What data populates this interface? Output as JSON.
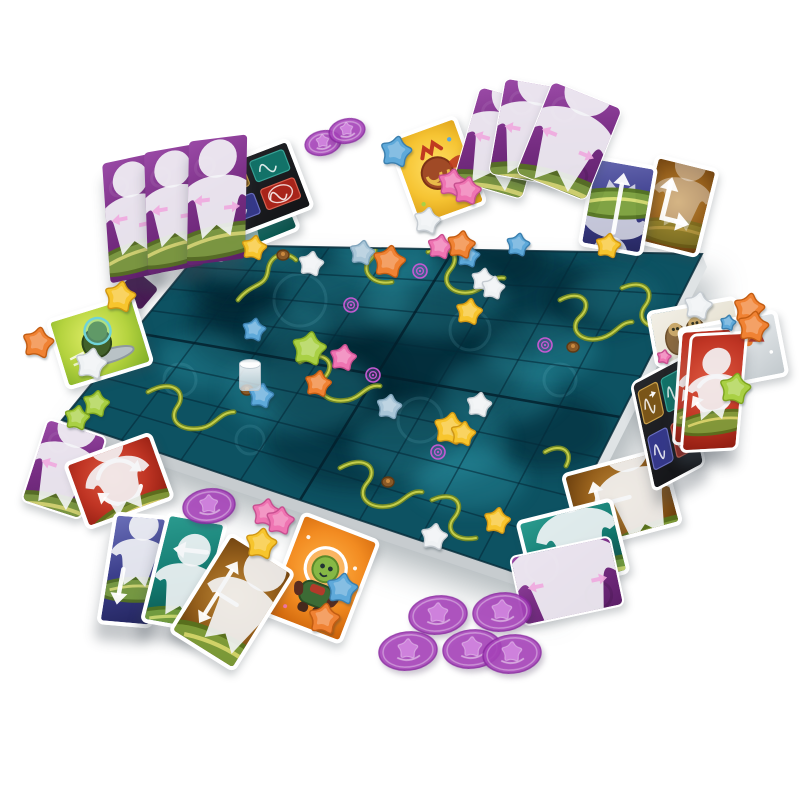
{
  "scene": {
    "title": "board-game-table-photo",
    "background": "#ffffff"
  },
  "board": {
    "corners": [
      [
        205,
        245
      ],
      [
        702,
        254
      ],
      [
        538,
        580
      ],
      [
        62,
        420
      ]
    ],
    "grid_divisions": 8,
    "base_color": "#0d5262",
    "edge_color": "#dfe3e5",
    "side_color": "#c7cccf",
    "line_color": "rgba(5,42,56,0.60)",
    "fold_color": "rgba(3,30,42,0.80)",
    "cloud_dark": "#02222e",
    "cloud_light": "#2f98a9",
    "clouds_dark": [
      [
        300,
        310,
        95,
        60
      ],
      [
        420,
        355,
        115,
        70
      ],
      [
        515,
        300,
        85,
        52
      ],
      [
        255,
        330,
        70,
        45
      ],
      [
        360,
        435,
        95,
        55
      ],
      [
        545,
        430,
        65,
        40
      ],
      [
        490,
        262,
        55,
        30
      ],
      [
        235,
        285,
        48,
        30
      ],
      [
        330,
        380,
        70,
        45
      ],
      [
        600,
        300,
        55,
        32
      ],
      [
        390,
        370,
        130,
        80
      ]
    ],
    "clouds_light": [
      [
        255,
        258,
        55,
        26
      ],
      [
        345,
        298,
        65,
        36
      ],
      [
        435,
        300,
        72,
        38
      ],
      [
        300,
        392,
        75,
        42
      ],
      [
        430,
        442,
        78,
        42
      ],
      [
        540,
        350,
        58,
        32
      ],
      [
        615,
        297,
        46,
        26
      ],
      [
        205,
        360,
        48,
        28
      ],
      [
        470,
        480,
        55,
        30
      ],
      [
        385,
        252,
        52,
        26
      ],
      [
        290,
        330,
        40,
        22
      ],
      [
        500,
        390,
        60,
        34
      ]
    ],
    "swirls": [
      [
        300,
        300,
        26
      ],
      [
        470,
        330,
        20
      ],
      [
        180,
        380,
        16
      ],
      [
        420,
        420,
        22
      ],
      [
        560,
        380,
        16
      ],
      [
        250,
        440,
        14
      ]
    ],
    "vines": [
      "M238,300 C252,282 266,288 268,270 C270,254 286,250 296,260",
      "M352,242 C372,232 382,248 370,260 C360,270 372,286 392,282",
      "M428,252 C450,242 462,256 450,270 C440,282 452,296 472,292 C486,288 492,276 504,278",
      "M560,300 C582,288 594,304 580,317 C568,328 580,344 602,338 C616,334 620,322 632,322",
      "M622,288 C644,278 656,292 645,306 C636,318 646,330 666,326",
      "M148,392 C172,378 188,392 177,407 C168,420 180,432 202,428 C216,425 220,412 234,412",
      "M300,362 C322,348 338,362 325,377 C314,390 326,404 348,400 C362,397 366,384 380,386",
      "M340,468 C364,454 380,468 367,483 C356,496 368,510 390,506 C404,503 408,490 422,492",
      "M432,500 C454,490 466,504 454,518 C444,530 456,542 476,538",
      "M545,452 C562,442 574,452 566,466"
    ],
    "vine_dark": "#6f8726",
    "vine_light": "#c8d24c",
    "pods": [
      [
        283,
        255
      ],
      [
        388,
        482
      ],
      [
        573,
        347
      ],
      [
        247,
        390
      ]
    ],
    "pod_color": "#8a5a28",
    "spirals": [
      [
        420,
        271
      ],
      [
        351,
        305
      ],
      [
        373,
        375
      ],
      [
        545,
        345
      ],
      [
        438,
        452
      ]
    ],
    "spiral_color": "#c45ad2",
    "cup": {
      "x": 239,
      "y": 362
    }
  },
  "star_colors": {
    "white": {
      "f": "#eff2f4",
      "s": "#c6ccd2"
    },
    "yellow": {
      "f": "#f7c52d",
      "s": "#cf9513"
    },
    "pink": {
      "f": "#ef74b2",
      "s": "#c74f90"
    },
    "blue": {
      "f": "#5ea9da",
      "s": "#3b7fae"
    },
    "lightblue": {
      "f": "#a9c6d8",
      "s": "#7fa3bb"
    },
    "orange": {
      "f": "#f08233",
      "s": "#c25c12"
    },
    "green": {
      "f": "#a9d044",
      "s": "#7da41f"
    }
  },
  "tokens": [
    {
      "color": "white",
      "x": 427,
      "y": 221,
      "s": 17
    },
    {
      "color": "pink",
      "x": 440,
      "y": 247,
      "s": 16
    },
    {
      "color": "lightblue",
      "x": 362,
      "y": 253,
      "s": 16
    },
    {
      "color": "orange",
      "x": 389,
      "y": 262,
      "s": 21
    },
    {
      "color": "white",
      "x": 311,
      "y": 264,
      "s": 16
    },
    {
      "color": "yellow",
      "x": 254,
      "y": 248,
      "s": 16
    },
    {
      "color": "blue",
      "x": 468,
      "y": 256,
      "s": 15
    },
    {
      "color": "white",
      "x": 483,
      "y": 280,
      "s": 15
    },
    {
      "color": "white",
      "x": 493,
      "y": 288,
      "s": 15
    },
    {
      "color": "yellow",
      "x": 469,
      "y": 312,
      "s": 17
    },
    {
      "color": "green",
      "x": 309,
      "y": 349,
      "s": 22
    },
    {
      "color": "pink",
      "x": 343,
      "y": 358,
      "s": 17
    },
    {
      "color": "orange",
      "x": 318,
      "y": 384,
      "s": 17
    },
    {
      "color": "blue",
      "x": 254,
      "y": 330,
      "s": 15
    },
    {
      "color": "blue",
      "x": 261,
      "y": 396,
      "s": 16
    },
    {
      "color": "lightblue",
      "x": 389,
      "y": 407,
      "s": 16
    },
    {
      "color": "white",
      "x": 479,
      "y": 405,
      "s": 16
    },
    {
      "color": "yellow",
      "x": 450,
      "y": 429,
      "s": 21
    },
    {
      "color": "yellow",
      "x": 463,
      "y": 434,
      "s": 16
    },
    {
      "color": "yellow",
      "x": 497,
      "y": 521,
      "s": 17
    },
    {
      "color": "white",
      "x": 434,
      "y": 537,
      "s": 17
    },
    {
      "color": "green",
      "x": 96,
      "y": 404,
      "s": 17
    },
    {
      "color": "green",
      "x": 77,
      "y": 418,
      "s": 16
    },
    {
      "color": "blue",
      "x": 518,
      "y": 245,
      "s": 15
    },
    {
      "color": "yellow",
      "x": 608,
      "y": 246,
      "s": 16
    },
    {
      "color": "blue",
      "x": 396,
      "y": 152,
      "s": 20
    },
    {
      "color": "pink",
      "x": 452,
      "y": 183,
      "s": 18
    },
    {
      "color": "pink",
      "x": 467,
      "y": 191,
      "s": 18
    },
    {
      "color": "orange",
      "x": 461,
      "y": 245,
      "s": 18
    },
    {
      "color": "white",
      "x": 698,
      "y": 306,
      "s": 18
    },
    {
      "color": "orange",
      "x": 749,
      "y": 309,
      "s": 20
    },
    {
      "color": "orange",
      "x": 753,
      "y": 327,
      "s": 20
    },
    {
      "color": "blue",
      "x": 728,
      "y": 323,
      "s": 10
    },
    {
      "color": "green",
      "x": 735,
      "y": 389,
      "s": 20
    },
    {
      "color": "pink",
      "x": 266,
      "y": 513,
      "s": 18
    },
    {
      "color": "pink",
      "x": 280,
      "y": 521,
      "s": 18
    },
    {
      "color": "yellow",
      "x": 261,
      "y": 544,
      "s": 20
    },
    {
      "color": "blue",
      "x": 342,
      "y": 589,
      "s": 20
    },
    {
      "color": "orange",
      "x": 324,
      "y": 619,
      "s": 20
    },
    {
      "color": "yellow",
      "x": 120,
      "y": 297,
      "s": 20
    },
    {
      "color": "orange",
      "x": 38,
      "y": 343,
      "s": 20
    },
    {
      "color": "white",
      "x": 91,
      "y": 364,
      "s": 20
    },
    {
      "color": "pink",
      "x": 664,
      "y": 357,
      "s": 9
    }
  ],
  "discs": {
    "fill": "#a944bc",
    "rim": "#8d2ba3",
    "emboss": "#e2a8ef",
    "items": [
      {
        "x": 323,
        "y": 143,
        "rx": 19,
        "ry": 13,
        "rot": -12
      },
      {
        "x": 347,
        "y": 131,
        "rx": 19,
        "ry": 13,
        "rot": -12
      },
      {
        "x": 209,
        "y": 506,
        "rx": 27,
        "ry": 18,
        "rot": -8
      },
      {
        "x": 438,
        "y": 615,
        "rx": 30,
        "ry": 20,
        "rot": -6
      },
      {
        "x": 502,
        "y": 612,
        "rx": 30,
        "ry": 20,
        "rot": -6
      },
      {
        "x": 408,
        "y": 651,
        "rx": 30,
        "ry": 20,
        "rot": -6
      },
      {
        "x": 472,
        "y": 649,
        "rx": 30,
        "ry": 20,
        "rot": -6
      },
      {
        "x": 512,
        "y": 654,
        "rx": 30,
        "ry": 20,
        "rot": -6
      }
    ]
  },
  "card_styles": {
    "purpleBack": {
      "bg": "linear-gradient(155deg,#9a4aa6 0%,#7a2f86 45%,#5c1f68 100%)"
    },
    "purpleDark": {
      "bg": "#4a1a55"
    },
    "red": {
      "bg": "radial-gradient(circle at 45% 40%,#e05a42 0%,#c03524 55%,#8e1c10 100%)"
    },
    "navyCard": {
      "bg": "linear-gradient(160deg,#6a6fb8 0%,#3c3f8c 50%,#23255e 100%)"
    },
    "tealCard": {
      "bg": "linear-gradient(160deg,#2a9a8e 0%,#137a70 55%,#0a4f48 100%)"
    },
    "brownCard": {
      "bg": "radial-gradient(circle at 50% 45%,#c08a38 0%,#96601c 55%,#63390c 100%)"
    },
    "blueCard": {
      "bg": "linear-gradient(165deg,#6466ae 0%,#3d3e8d 50%,#26275f 100%)"
    },
    "gold": {
      "bg": "radial-gradient(circle at 50% 45%,#ffe066 0%,#f6c433 55%,#d89a14 100%)"
    },
    "greenCard": {
      "bg": "radial-gradient(circle at 45% 40%,#e2ef6a 0%,#b5d33f 55%,#7fae26 100%)"
    },
    "grayCard": {
      "bg": "linear-gradient(150deg,#f2f4f5 0%,#d9dee1 60%,#c2c9cd 100%)"
    },
    "slothCard": {
      "bg": "linear-gradient(150deg,#f2efe6 0%,#e2dcca 100%)"
    },
    "blackRef": {
      "bg": "linear-gradient(150deg,#26272b 0%,#121316 100%)"
    },
    "orangeCard": {
      "bg": "radial-gradient(circle at 50% 42%,#ffb347 0%,#f28b21 55%,#c85f08 100%)"
    }
  },
  "cards": [
    {
      "id": "teal-summary-card-top",
      "x": 247,
      "y": 217,
      "w": 92,
      "h": 64,
      "rot": -22,
      "skew": 0,
      "style": "tealCard",
      "motif": "tealFigure",
      "z": 2,
      "b": 4,
      "stand": false
    },
    {
      "id": "reference-card-top-left",
      "x": 256,
      "y": 190,
      "w": 98,
      "h": 76,
      "rot": -21,
      "skew": 0,
      "style": "blackRef",
      "motif": "reference4",
      "z": 3,
      "b": 4,
      "stand": false
    },
    {
      "id": "player-screen-left-1",
      "x": 133,
      "y": 218,
      "w": 54,
      "h": 120,
      "rot": -4,
      "skew": -8,
      "style": "purpleBack",
      "motif": "screenBack",
      "z": 5,
      "b": 0,
      "stand": true
    },
    {
      "id": "player-screen-left-2",
      "x": 174,
      "y": 209,
      "w": 56,
      "h": 122,
      "rot": -2,
      "skew": -8,
      "style": "purpleBack",
      "motif": "screenBack",
      "z": 5,
      "b": 0,
      "stand": true
    },
    {
      "id": "player-screen-left-3",
      "x": 217,
      "y": 200,
      "w": 58,
      "h": 124,
      "rot": 1,
      "skew": -8,
      "style": "purpleBack",
      "motif": "screenBack",
      "z": 5,
      "b": 0,
      "stand": true
    },
    {
      "id": "creature-card-yellow",
      "x": 437,
      "y": 171,
      "w": 74,
      "h": 95,
      "rot": -20,
      "skew": 0,
      "style": "gold",
      "motif": "creature",
      "z": 3,
      "b": 4,
      "stand": false
    },
    {
      "id": "card-back-fan-1",
      "x": 501,
      "y": 143,
      "w": 72,
      "h": 98,
      "rot": 16,
      "skew": 0,
      "style": "purpleBack",
      "motif": "screenBack",
      "z": 3,
      "b": 1,
      "stand": false
    },
    {
      "id": "card-back-fan-2",
      "x": 532,
      "y": 132,
      "w": 72,
      "h": 98,
      "rot": 10,
      "skew": 0,
      "style": "purpleBack",
      "motif": "screenBack",
      "z": 4,
      "b": 1,
      "stand": false
    },
    {
      "id": "card-back-fan-3",
      "x": 569,
      "y": 141,
      "w": 76,
      "h": 100,
      "rot": 22,
      "skew": 0,
      "style": "purpleBack",
      "motif": "screenBack",
      "z": 5,
      "b": 1,
      "stand": false
    },
    {
      "id": "movement-card-brown-bent",
      "x": 677,
      "y": 206,
      "w": 66,
      "h": 92,
      "rot": 14,
      "skew": 0,
      "style": "brownCard",
      "motif": "bentArrow",
      "z": 3,
      "b": 4,
      "stand": false
    },
    {
      "id": "movement-card-blue-up",
      "x": 618,
      "y": 206,
      "w": 66,
      "h": 92,
      "rot": 10,
      "skew": 0,
      "style": "blueCard",
      "motif": "upArrow",
      "z": 4,
      "b": 4,
      "stand": false
    },
    {
      "id": "creature-card-sloths",
      "x": 696,
      "y": 332,
      "w": 92,
      "h": 58,
      "rot": -10,
      "skew": 0,
      "style": "slothCard",
      "motif": "sloths",
      "z": 2,
      "b": 4,
      "stand": false
    },
    {
      "id": "creature-card-robot-arm",
      "x": 733,
      "y": 352,
      "w": 102,
      "h": 68,
      "rot": -11,
      "skew": 0,
      "style": "grayCard",
      "motif": "robotArm",
      "z": 3,
      "b": 4,
      "stand": false
    },
    {
      "id": "reference-card-standing",
      "x": 668,
      "y": 424,
      "w": 58,
      "h": 112,
      "rot": -12,
      "skew": -16,
      "style": "blackRef",
      "motif": "reference4",
      "z": 4,
      "b": 3,
      "stand": true
    },
    {
      "id": "movement-card-red-standing-back",
      "x": 703,
      "y": 386,
      "w": 54,
      "h": 116,
      "rot": 4,
      "skew": -8,
      "style": "red",
      "motif": "rotate",
      "z": 4,
      "b": 3,
      "stand": true
    },
    {
      "id": "movement-card-red-standing",
      "x": 714,
      "y": 392,
      "w": 58,
      "h": 120,
      "rot": 5,
      "skew": -8,
      "style": "red",
      "motif": "rotate",
      "z": 5,
      "b": 3,
      "stand": true
    },
    {
      "id": "movement-card-brown-t-flat",
      "x": 622,
      "y": 499,
      "w": 106,
      "h": 80,
      "rot": -15,
      "skew": 0,
      "style": "brownCard",
      "motif": "tArrow",
      "z": 3,
      "b": 4,
      "stand": false
    },
    {
      "id": "movement-card-teal-down-flat",
      "x": 573,
      "y": 547,
      "w": 100,
      "h": 78,
      "rot": -14,
      "skew": 0,
      "style": "tealCard",
      "motif": "figureDown",
      "z": 4,
      "b": 4,
      "stand": false
    },
    {
      "id": "card-back-purple-bottom-right",
      "x": 567,
      "y": 581,
      "w": 104,
      "h": 72,
      "rot": -12,
      "skew": 0,
      "style": "purpleBack",
      "motif": "screenBack",
      "z": 5,
      "b": 2,
      "stand": false
    },
    {
      "id": "card-back-purple-bottom-left",
      "x": 64,
      "y": 469,
      "w": 64,
      "h": 88,
      "rot": 18,
      "skew": 0,
      "style": "purpleBack",
      "motif": "screenBack",
      "z": 3,
      "b": 2,
      "stand": false
    },
    {
      "id": "movement-card-red-rotate",
      "x": 119,
      "y": 481,
      "w": 94,
      "h": 72,
      "rot": -20,
      "skew": 0,
      "style": "red",
      "motif": "rotate",
      "z": 4,
      "b": 4,
      "stand": false
    },
    {
      "id": "movement-card-navy-down",
      "x": 133,
      "y": 570,
      "w": 56,
      "h": 114,
      "rot": 9,
      "skew": -4,
      "style": "navyCard",
      "motif": "figureDown",
      "z": 5,
      "b": 4,
      "stand": true
    },
    {
      "id": "movement-card-teal-left",
      "x": 184,
      "y": 572,
      "w": 62,
      "h": 114,
      "rot": 14,
      "skew": -4,
      "style": "tealCard",
      "motif": "figureLeft",
      "z": 5,
      "b": 4,
      "stand": true
    },
    {
      "id": "movement-card-brown-t-fan",
      "x": 232,
      "y": 602,
      "w": 78,
      "h": 118,
      "rot": 32,
      "skew": 0,
      "style": "brownCard",
      "motif": "tArrow",
      "z": 5,
      "b": 4,
      "stand": false
    },
    {
      "id": "creature-card-astronaut",
      "x": 322,
      "y": 578,
      "w": 84,
      "h": 112,
      "rot": 21,
      "skew": 0,
      "style": "orangeCard",
      "motif": "astronaut",
      "z": 4,
      "b": 4,
      "stand": false
    },
    {
      "id": "creature-card-alien",
      "x": 100,
      "y": 342,
      "w": 92,
      "h": 74,
      "rot": -17,
      "skew": 0,
      "style": "greenCard",
      "motif": "alien",
      "z": 3,
      "b": 4,
      "stand": false
    },
    {
      "id": "purple-card-corner",
      "x": 138,
      "y": 290,
      "w": 30,
      "h": 28,
      "rot": 40,
      "skew": 0,
      "style": "purpleDark",
      "motif": "none",
      "z": 2,
      "b": 0,
      "stand": false
    }
  ]
}
